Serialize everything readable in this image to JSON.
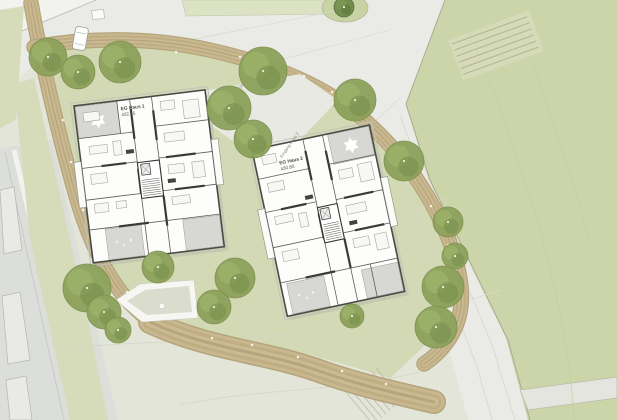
{
  "document": {
    "kind": "architectural-site-plan",
    "description": "Landscape site plan with two residential buildings (ground floor plans), tree ring, gravel loop path, plaza and meadow"
  },
  "palette": {
    "meadow_green": "#ccd5a9",
    "lawn_green": "#d3d9b4",
    "field_pale": "#e2e5d8",
    "paving_gray": "#eaebe6",
    "gravel_brown": "#c8b78f",
    "gravel_edge": "#b4a47c",
    "tree_olive": "#8da25c",
    "tree_light": "#9db36a",
    "tree_shadow": "#7a914e",
    "tree_dark": "#6e8a49",
    "building_fill": "#fdfdfb",
    "wall_dark": "#4a4a46",
    "terrace_gray": "#d7d8d3",
    "road_gray": "#dcdeda",
    "white": "#ffffff"
  },
  "site": {
    "buildings": [
      {
        "id": "haus-1",
        "floor_label": "EG Haus 1",
        "elevation": "432.75",
        "entrance_label": "Eingang Haus 1"
      },
      {
        "id": "haus-2",
        "floor_label": "EG Haus 2",
        "elevation": "430.80",
        "entrance_label": "Eingang Haus 2"
      }
    ],
    "objects": {
      "parked_car": true,
      "playground": true,
      "seat_steps": true,
      "stair_ramp": true
    },
    "trees": [
      [
        48,
        57,
        19
      ],
      [
        78,
        72,
        17
      ],
      [
        120,
        62,
        21
      ],
      [
        263,
        71,
        24
      ],
      [
        229,
        108,
        22
      ],
      [
        253,
        139,
        19
      ],
      [
        355,
        100,
        21
      ],
      [
        404,
        161,
        20
      ],
      [
        448,
        222,
        15
      ],
      [
        455,
        256,
        13
      ],
      [
        443,
        287,
        21
      ],
      [
        436,
        327,
        21
      ],
      [
        87,
        288,
        24
      ],
      [
        104,
        312,
        17
      ],
      [
        118,
        330,
        13
      ],
      [
        158,
        267,
        16
      ],
      [
        235,
        278,
        20
      ],
      [
        214,
        307,
        17
      ],
      [
        352,
        316,
        12
      ],
      [
        344,
        7,
        10,
        "dark"
      ]
    ],
    "path_lights": [
      [
        63,
        120
      ],
      [
        71,
        162
      ],
      [
        83,
        210
      ],
      [
        97,
        247
      ],
      [
        127,
        292
      ],
      [
        162,
        306
      ],
      [
        212,
        338
      ],
      [
        252,
        345
      ],
      [
        298,
        357
      ],
      [
        342,
        371
      ],
      [
        386,
        384
      ],
      [
        332,
        92
      ],
      [
        362,
        113
      ],
      [
        399,
        155
      ],
      [
        431,
        206
      ],
      [
        448,
        245
      ],
      [
        456,
        282
      ],
      [
        176,
        52
      ],
      [
        240,
        57
      ],
      [
        304,
        76
      ]
    ]
  }
}
